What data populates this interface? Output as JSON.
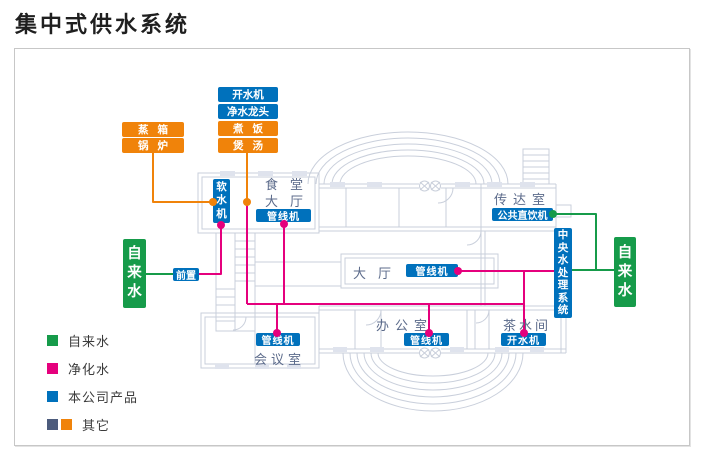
{
  "title": "集中式供水系统",
  "colors": {
    "tap_water": "#169b4a",
    "purified_water": "#e5007d",
    "product_blue": "#0071bc",
    "other_slate": "#4c5b7c",
    "other_orange": "#f0830a",
    "floorplan_gray": "#c9cfdb",
    "window_fill": "#dfe3ed",
    "room_label": "#5c6b8b"
  },
  "diagram": {
    "tap_left": "自来水",
    "tap_right": "自来水",
    "prefilter": "前置",
    "softener": "软水机",
    "central_system": "中央水处理系统",
    "public_drinker": "公共直饮机",
    "boiler_room": {
      "steam_box": "蒸箱",
      "boiler": "锅炉"
    },
    "kitchen_stack": {
      "water_boiler": "开水机",
      "water_faucet": "净水龙头",
      "cook": "煮饭",
      "soup": "煲汤"
    },
    "canteen": {
      "room_line1": "食堂",
      "room_line2": "大厅",
      "device": "管线机"
    },
    "reception": {
      "room": "传达室"
    },
    "hall": {
      "room": "大厅",
      "device": "管线机"
    },
    "office": {
      "room": "办公室",
      "device": "管线机"
    },
    "tea_room": {
      "room": "茶水间",
      "device": "开水机"
    },
    "meeting_room": {
      "room": "会议室",
      "device": "管线机"
    }
  },
  "legend": {
    "tap": {
      "label": "自来水"
    },
    "purified": {
      "label": "净化水"
    },
    "product": {
      "label": "本公司产品"
    },
    "other": {
      "label": "其它"
    }
  }
}
